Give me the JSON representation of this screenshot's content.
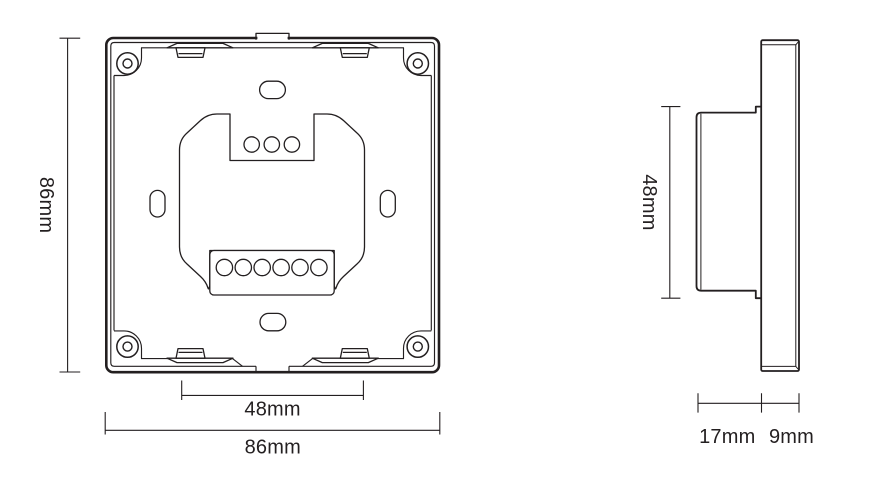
{
  "views": {
    "front": {
      "height_label": "86mm",
      "mounting_width_label": "48mm",
      "width_label": "86mm"
    },
    "side": {
      "body_height_label": "48mm",
      "base_depth_label": "17mm",
      "faceplate_depth_label": "9mm"
    }
  },
  "style": {
    "line_color": "#231f20",
    "background": "#ffffff"
  }
}
